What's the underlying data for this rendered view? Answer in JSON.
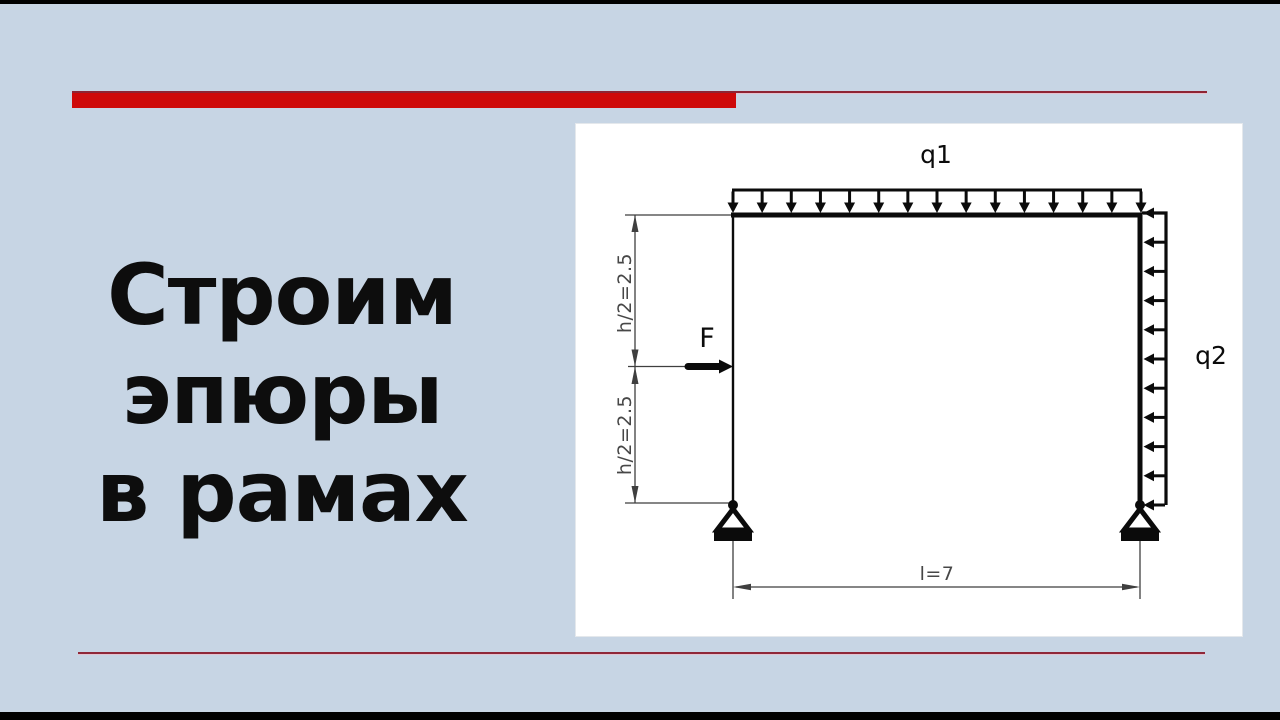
{
  "slide": {
    "background_color": "#c7d5e4",
    "title_lines": [
      "Строим",
      "эпюры",
      "в рамах"
    ],
    "title_color": "#0d0d0d",
    "accent_bar_color": "#ce0909",
    "accent_line_color": "#8e2433",
    "footer_line_color": "#8f2838"
  },
  "diagram": {
    "labels": {
      "load_top": "q1",
      "load_side": "q2",
      "force": "F",
      "height_upper": "h/2=2.5",
      "height_lower": "h/2=2.5",
      "span": "l=7"
    },
    "loads": {
      "q1_arrow_count": 15,
      "q2_arrow_count": 11
    },
    "colors": {
      "ink": "#0b0b0b",
      "dimension": "#3f3f3f",
      "dimension_text": "#474747"
    }
  }
}
